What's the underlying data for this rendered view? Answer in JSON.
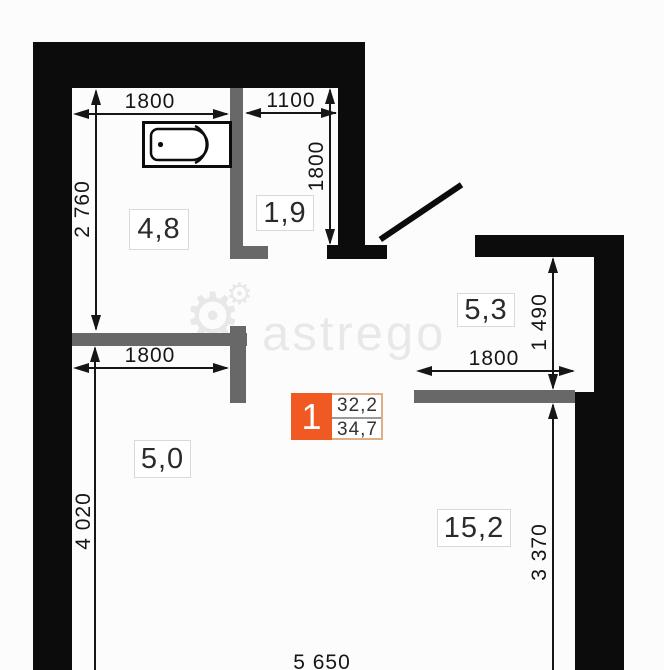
{
  "unit_badge": {
    "number": "1",
    "area_top": "32,2",
    "area_bottom": "34,7"
  },
  "rooms": {
    "bathroom": "4,8",
    "hallway": "1,9",
    "kitchen": "5,3",
    "corridor": "5,0",
    "living_room": "15,2"
  },
  "dimensions": {
    "bathroom_width": "1800",
    "hallway_width": "1100",
    "hallway_height": "1800",
    "bathroom_height": "2 760",
    "corridor_height": "4 020",
    "corridor_width": "1800",
    "living_width": "1800",
    "kitchen_height": "1 490",
    "living_height": "3 370",
    "bottom_width": "5 650"
  },
  "watermark": {
    "text": "astrego",
    "gear_icon": "⚙"
  },
  "colors": {
    "wall": "#0c0c0c",
    "partition": "#686868",
    "accent": "#f05a22",
    "badge_border": "#dfae83",
    "dimension": "#161616",
    "label_border": "#d9d9d9",
    "watermark": "rgba(0,0,0,0.08)"
  }
}
